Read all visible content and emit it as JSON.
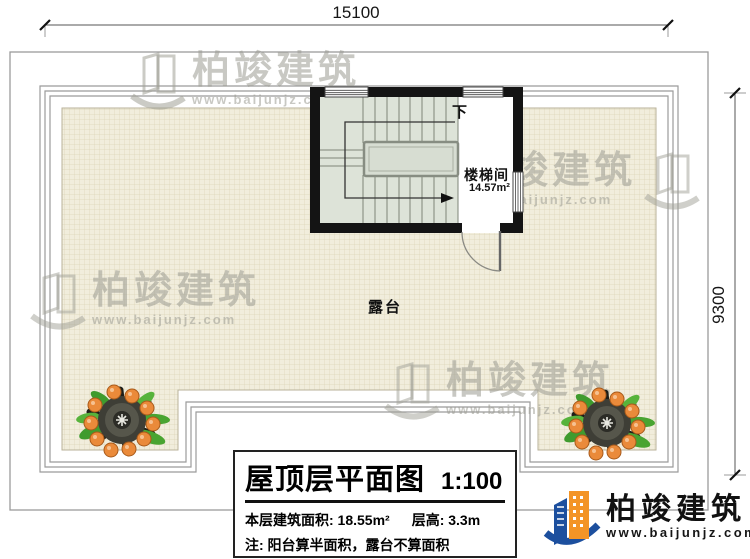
{
  "dimensions": {
    "width_label": "15100",
    "height_label": "9300"
  },
  "stairwell": {
    "name": "楼梯间",
    "area": "14.57m²",
    "down_label": "下"
  },
  "terrace": {
    "label": "露台"
  },
  "title_block": {
    "title": "屋顶层平面图",
    "scale": "1:100",
    "area_text": "本层建筑面积: 18.55m²",
    "height_text": "层高: 3.3m",
    "note_text": "注: 阳台算半面积，露台不算面积"
  },
  "brand": {
    "name": "柏竣建筑",
    "website": "www.baijunjz.com"
  },
  "icons": {
    "plant": "potted-plant-top-view",
    "brand_logo": "building-swoosh-logo"
  },
  "colors": {
    "wall": "#141414",
    "tile_fill": "#f1eddc",
    "tile_grid": "#dcd4b8",
    "stair_fill": "#dde3d8",
    "outline_gray": "#9b9b9b",
    "brand_blue": "#1c4f9e",
    "brand_orange": "#f39426",
    "leaf_green": "#49a431",
    "fruit_orange": "#ea8a3a",
    "watermark_gray": "#a8a89e"
  }
}
